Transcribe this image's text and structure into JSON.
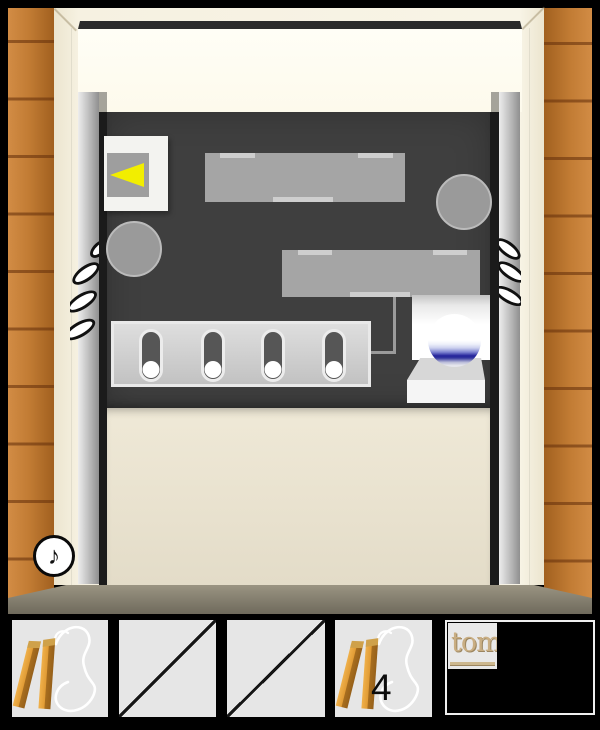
{
  "scene": {
    "name": "room-escape-doorway",
    "sound_button": {
      "glyph": "♪"
    },
    "wall_panel": {
      "picture_frame": {
        "arrow_direction": "left",
        "arrow_color": "#f2ee00"
      },
      "slider_panel": {
        "slot_count": 4,
        "ball_color": "#ffffff"
      },
      "marble": {
        "glass_blue": "#23239a"
      }
    },
    "colors": {
      "wood": "#c27c34",
      "door_cream": "#f6f1e1",
      "panel_dark": "#3f3f3f",
      "floor": "#8d8777"
    }
  },
  "inventory": {
    "slots": [
      {
        "name": "wooden-sticks-with-string",
        "state": "filled"
      },
      {
        "state": "empty"
      },
      {
        "state": "empty"
      },
      {
        "name": "wooden-sticks-with-string",
        "state": "filled",
        "count": "4"
      }
    ],
    "brand": {
      "text": "tom"
    }
  }
}
